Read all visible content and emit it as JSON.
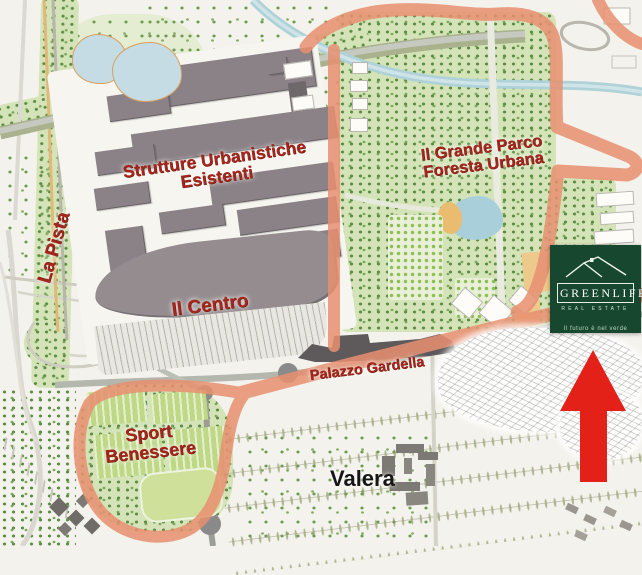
{
  "map": {
    "labels": {
      "strutture": {
        "line1": "Strutture Urbanistiche",
        "line2": "Esistenti"
      },
      "la_pista": "La Pista",
      "il_centro": "Il Centro",
      "grande_parco": {
        "line1": "Il Grande Parco",
        "line2": "Foresta Urbana"
      },
      "palazzo_gardella": "Palazzo Gardella",
      "sport_benessere": {
        "line1": "Sport",
        "line2": "Benessere"
      },
      "valera": "Valera"
    },
    "colors": {
      "boundary": "#E89070",
      "label_red": "#A3271D",
      "label_black": "#161616",
      "building_gray": "#8A8286",
      "park_green": "#D5E4B8",
      "water_blue": "#AED2D8",
      "arrow_red": "#E32119",
      "logo_green": "#17482F"
    }
  },
  "logo": {
    "brand": "GREENLIFE",
    "subtitle": "REAL ESTATE",
    "tagline": "Il futuro è nel verde"
  },
  "marker": {
    "shape": "arrow-up",
    "color": "#E32119"
  }
}
